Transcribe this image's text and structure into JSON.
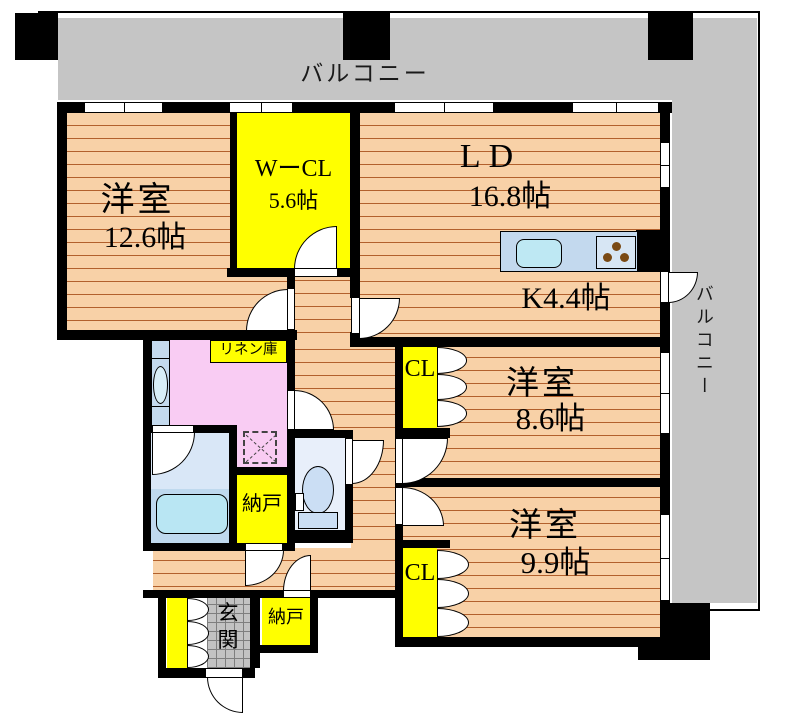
{
  "colors": {
    "wall": "#000000",
    "wood_floor": "#f8d1a7",
    "wood_line": "#b2602c",
    "closet_yellow": "#ffff00",
    "balcony_gray": "#c5c5c5",
    "washroom_pink": "#f9ccf3",
    "bath_blue": "#bfd9ee",
    "tub_blue": "#b9e6f3",
    "fixture_blue": "#c3d9ee",
    "entrance_tile_gray": "#c2c2c2",
    "stove_dot_brown": "#7a4a14"
  },
  "balconies": {
    "top": {
      "label": "バルコニー"
    },
    "right": {
      "label": "バルコニー"
    }
  },
  "rooms": {
    "bedroom1": {
      "name": "洋室",
      "area": "12.6帖"
    },
    "walk_in_closet": {
      "name": "WーCL",
      "area": "5.6帖"
    },
    "living_dining": {
      "name": "LD",
      "area": "16.8帖"
    },
    "kitchen": {
      "name": "K4.4帖"
    },
    "bedroom2": {
      "name": "洋室",
      "area": "8.6帖"
    },
    "bedroom3": {
      "name": "洋室",
      "area": "9.9帖"
    },
    "closet_bedroom2": {
      "label": "CL"
    },
    "closet_bedroom3": {
      "label": "CL"
    },
    "linen_closet": {
      "label": "リネン庫"
    },
    "storage1": {
      "label": "納戸"
    },
    "storage2": {
      "label": "納戸"
    },
    "entrance": {
      "label": "玄関"
    }
  }
}
